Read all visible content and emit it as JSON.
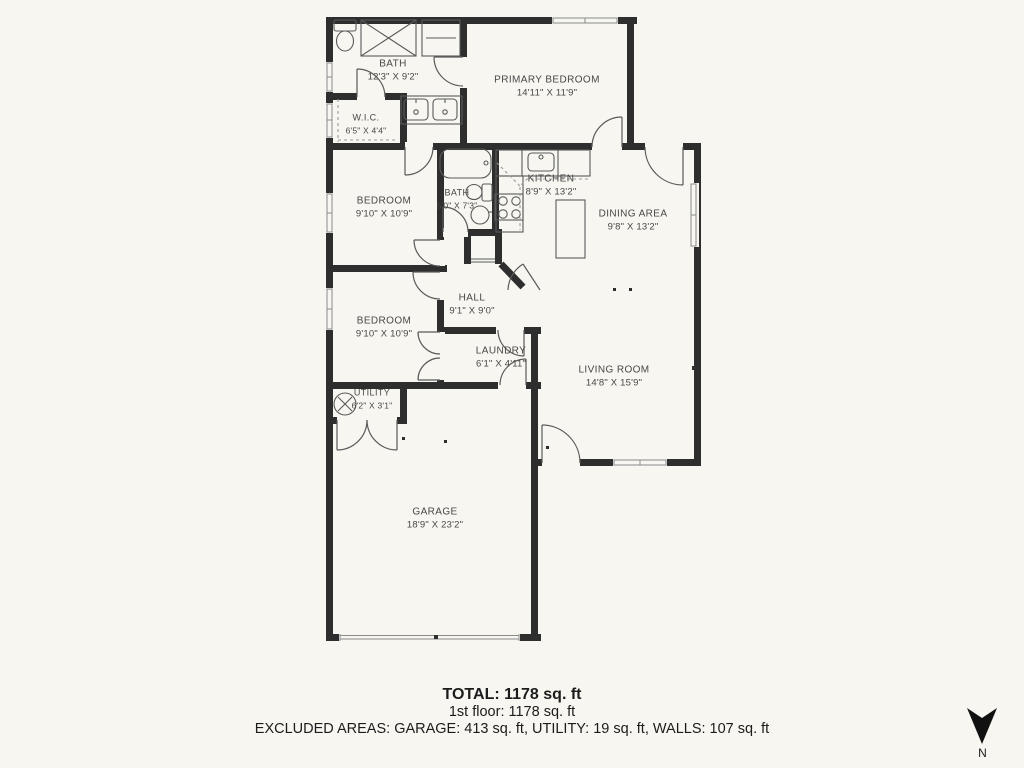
{
  "plan": {
    "background": "#f7f6f1",
    "wall_color": "#2e2e2e",
    "fixture_color": "#5a5a5a"
  },
  "rooms": [
    {
      "id": "bath-main",
      "name": "BATH",
      "dims": "12'3\" X 9'2\"",
      "x": 393,
      "y": 71
    },
    {
      "id": "wic",
      "name": "W.I.C.",
      "dims": "6'5\" X 4'4\"",
      "x": 366,
      "y": 124
    },
    {
      "id": "primary-bedroom",
      "name": "PRIMARY BEDROOM",
      "dims": "14'11\" X 11'9\"",
      "x": 547,
      "y": 87
    },
    {
      "id": "bedroom-1",
      "name": "BEDROOM",
      "dims": "9'10\" X 10'9\"",
      "x": 384,
      "y": 208
    },
    {
      "id": "bath-2",
      "name": "BATH",
      "dims": "5'0\" X 7'3\"",
      "x": 457,
      "y": 199
    },
    {
      "id": "kitchen",
      "name": "KITCHEN",
      "dims": "8'9\" X 13'2\"",
      "x": 551,
      "y": 186
    },
    {
      "id": "dining-area",
      "name": "DINING AREA",
      "dims": "9'8\" X 13'2\"",
      "x": 633,
      "y": 221
    },
    {
      "id": "hall",
      "name": "HALL",
      "dims": "9'1\" X 9'0\"",
      "x": 472,
      "y": 305
    },
    {
      "id": "bedroom-2",
      "name": "BEDROOM",
      "dims": "9'10\" X 10'9\"",
      "x": 384,
      "y": 328
    },
    {
      "id": "laundry",
      "name": "LAUNDRY",
      "dims": "6'1\" X 4'11\"",
      "x": 501,
      "y": 358
    },
    {
      "id": "utility",
      "name": "UTILITY",
      "dims": "6'2\" X 3'1\"",
      "x": 372,
      "y": 399
    },
    {
      "id": "living-room",
      "name": "LIVING ROOM",
      "dims": "14'8\" X 15'9\"",
      "x": 614,
      "y": 377
    },
    {
      "id": "garage",
      "name": "GARAGE",
      "dims": "18'9\" X 23'2\"",
      "x": 435,
      "y": 519
    }
  ],
  "summary": {
    "total": "TOTAL: 1178 sq. ft",
    "floor": "1st floor: 1178 sq. ft",
    "excluded": "EXCLUDED AREAS: GARAGE: 413 sq. ft, UTILITY: 19 sq. ft, WALLS: 107 sq. ft"
  },
  "compass": {
    "label": "N"
  }
}
